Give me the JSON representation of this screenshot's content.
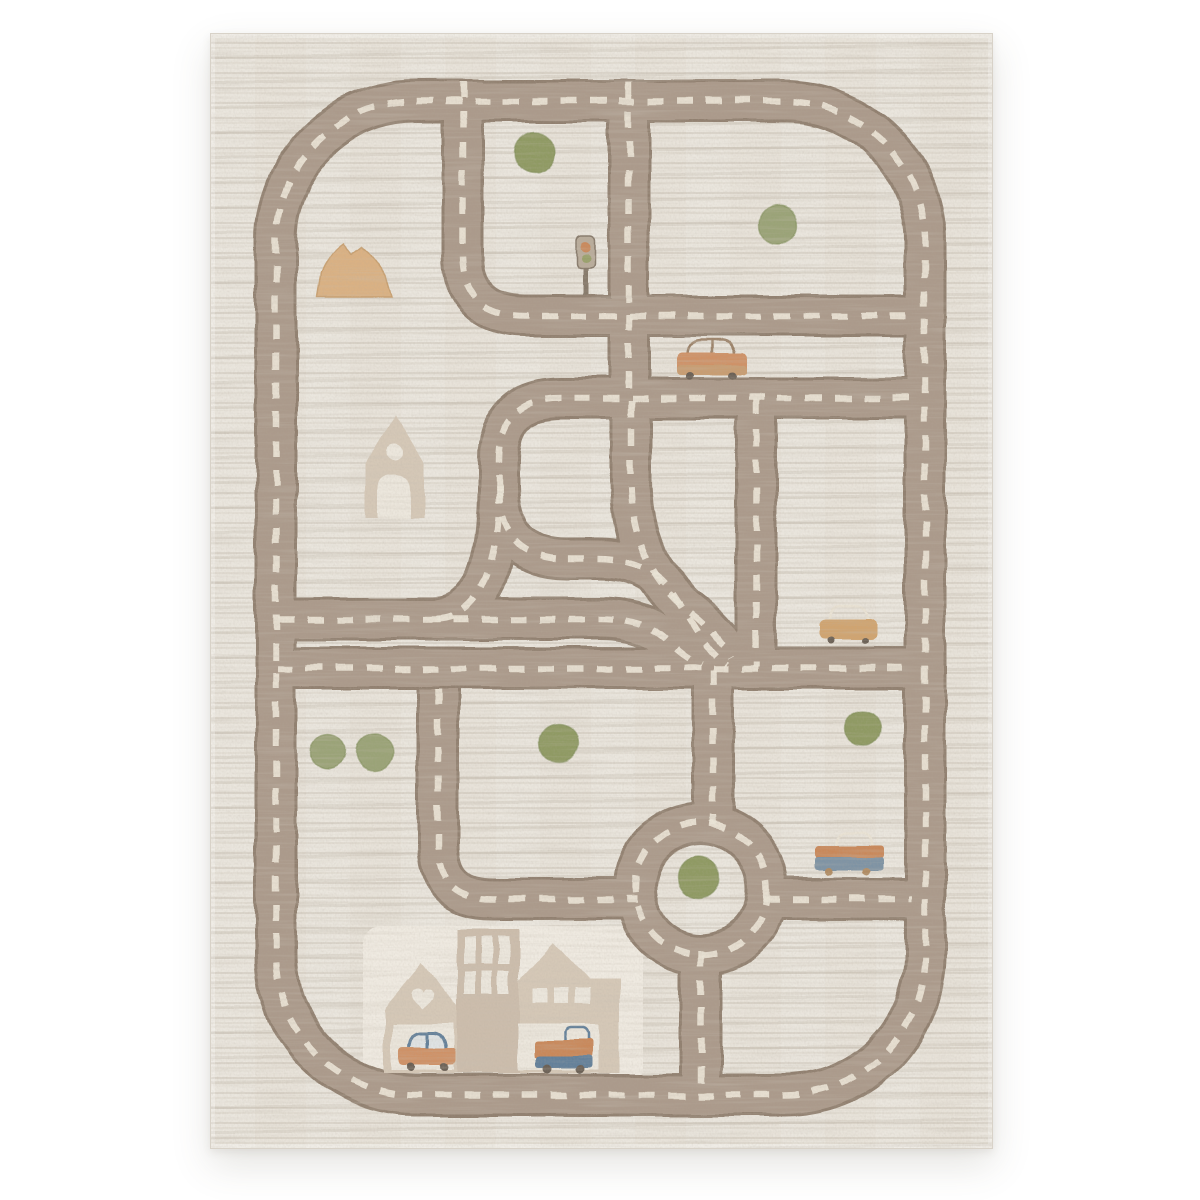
{
  "image_type": "product photograph, no visible text",
  "subject": "kids' city road play rug with dashed-line streets, roundabout, houses, trees and cars",
  "backdrop": "plain white studio background with soft shadow under the rug",
  "rug": {
    "texture": "cream carpet with horizontal mottled beige striations",
    "road_style": "taupe roads with cream stitched dashed center lines",
    "features": {
      "outer_ring_road": 1,
      "roundabout": 1,
      "traffic_light": 1,
      "mountain": 1,
      "trees": 7,
      "houses": 4,
      "vehicles": 5
    },
    "vehicles": [
      {
        "name": "orange car with outlined roof",
        "location": "upper middle road"
      },
      {
        "name": "sand-yellow car with cream outlined roof",
        "location": "middle right road"
      },
      {
        "name": "blue wagon with orange stripe and cream outlined roof",
        "location": "right of roundabout"
      },
      {
        "name": "salmon car with slate roof",
        "location": "left garage at bottom houses"
      },
      {
        "name": "orange truck with blue base",
        "location": "right garage at bottom houses"
      }
    ],
    "buildings": [
      {
        "name": "church-like house with round window and arched door",
        "location": "middle left"
      },
      {
        "name": "peaked house with heart window",
        "location": "bottom left"
      },
      {
        "name": "tall tower with window slits",
        "location": "bottom center"
      },
      {
        "name": "wide house with three square windows",
        "location": "bottom center-right"
      }
    ]
  },
  "palette": {
    "bg": "#ffffff",
    "rugBase": "#e8e3da",
    "rugEdgeLine": "#d8d2c8",
    "road": "#ab9a8b",
    "roadEdge": "#91806f",
    "dash": "#ece5d7",
    "treeA": "#8f9a63",
    "treeB": "#9aa377",
    "treeEdge": "#7e8c57",
    "house": "#d5c8b7",
    "houseAlt": "#ccbdac",
    "houseCut": "#ece7dd",
    "backdropLight": "#efeae1",
    "mountain": "#dab183",
    "mountainEdge": "#c8a071",
    "carOrange": "#cf9166",
    "carSand": "#c89d72",
    "carYellow": "#d0a470",
    "slate": "#64809a",
    "slateLight": "#7e93a4",
    "truckOrange": "#c9885a",
    "wheelDark": "#6b6055",
    "wheelTan": "#b08b62",
    "outlineBrown": "#9b8168",
    "outlineCream": "#eae3d5",
    "signalBox": "#b9ac9b",
    "signalOrange": "#c9895c",
    "signalGreen": "#98a06a",
    "poleBrown": "#86796a"
  }
}
